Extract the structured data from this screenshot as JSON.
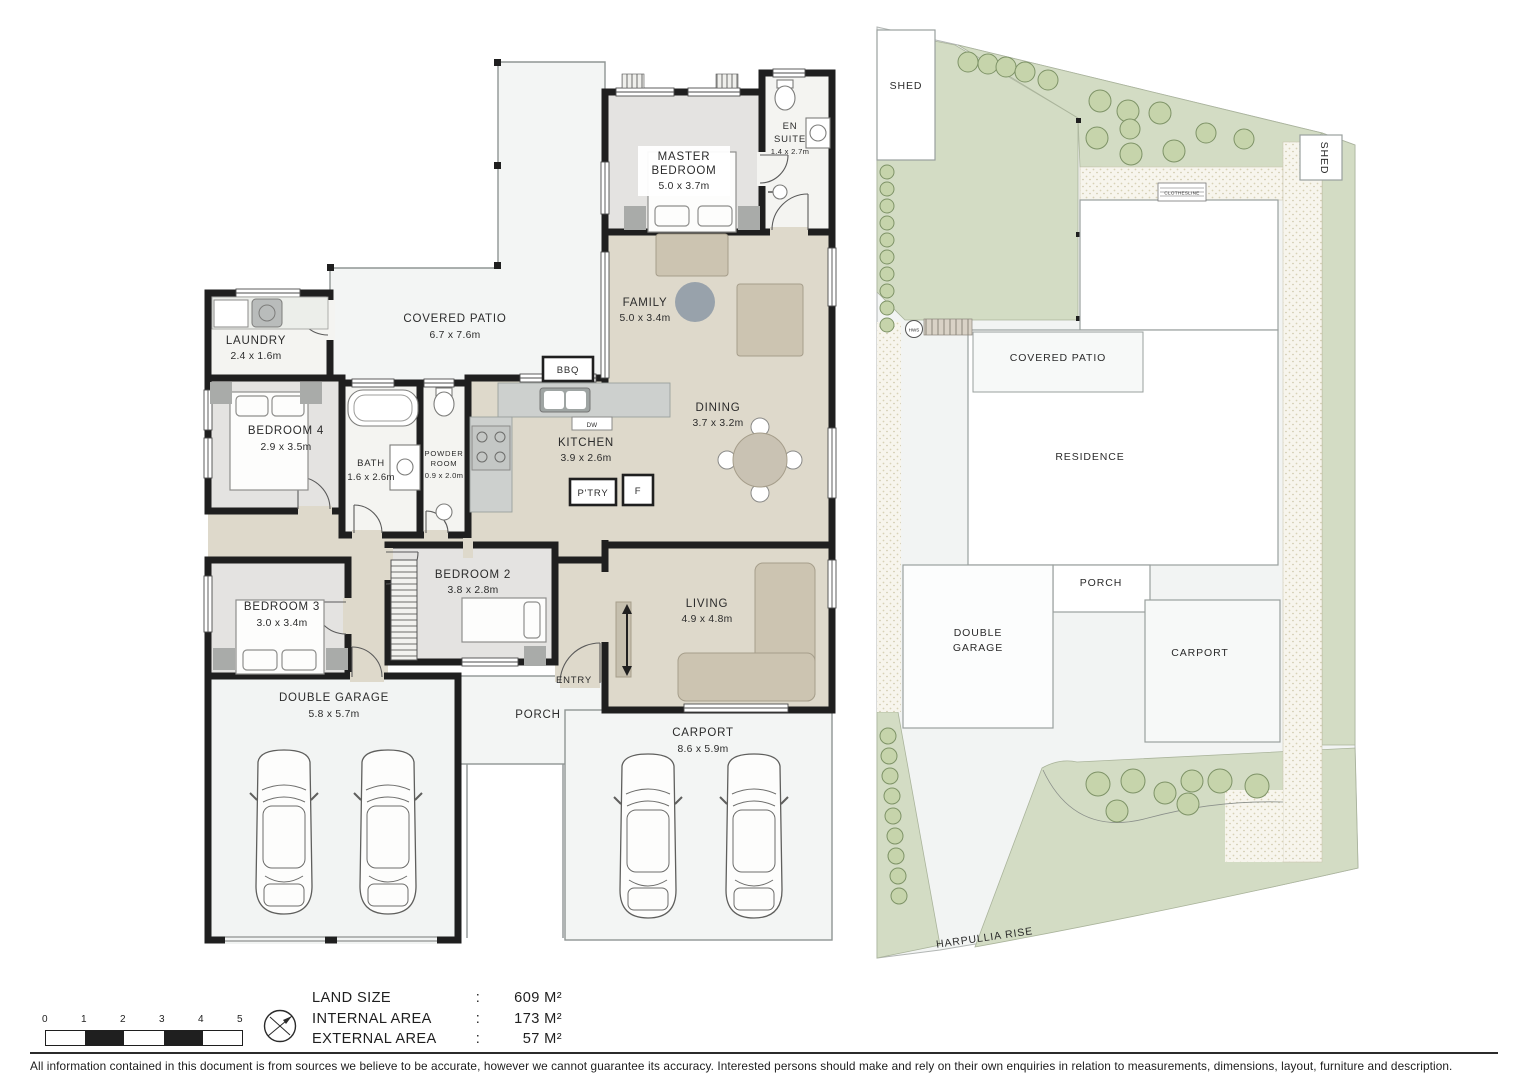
{
  "floorplan": {
    "rooms": {
      "covered_patio": {
        "name": "COVERED PATIO",
        "dims": "6.7 x 7.6m"
      },
      "master": {
        "l1": "MASTER",
        "l2": "BEDROOM",
        "dims": "5.0 x 3.7m"
      },
      "ensuite": {
        "l1": "EN",
        "l2": "SUITE",
        "dims": "1.4 x 2.7m"
      },
      "laundry": {
        "name": "LAUNDRY",
        "dims": "2.4 x 1.6m"
      },
      "family": {
        "name": "FAMILY",
        "dims": "5.0 x 3.4m"
      },
      "bed4": {
        "name": "BEDROOM 4",
        "dims": "2.9 x 3.5m"
      },
      "bath": {
        "name": "BATH",
        "dims": "1.6 x 2.6m"
      },
      "powder": {
        "l1": "POWDER",
        "l2": "ROOM",
        "dims": "0.9 x 2.0m"
      },
      "kitchen": {
        "name": "KITCHEN",
        "dims": "3.9 x 2.6m"
      },
      "dining": {
        "name": "DINING",
        "dims": "3.7 x 3.2m"
      },
      "bed3": {
        "name": "BEDROOM 3",
        "dims": "3.0 x 3.4m"
      },
      "bed2": {
        "name": "BEDROOM 2",
        "dims": "3.8 x 2.8m"
      },
      "living": {
        "name": "LIVING",
        "dims": "4.9 x 4.8m"
      },
      "garage": {
        "name": "DOUBLE GARAGE",
        "dims": "5.8 x 5.7m"
      },
      "porch": {
        "name": "PORCH"
      },
      "entry": {
        "name": "ENTRY"
      },
      "carport": {
        "name": "CARPORT",
        "dims": "8.6 x 5.9m"
      }
    },
    "features": {
      "bbq": "BBQ",
      "pantry": "P'TRY",
      "fridge": "F",
      "dishwasher": "DW"
    }
  },
  "siteplan": {
    "shed_left": "SHED",
    "shed_right": "SHED",
    "covered_patio": "COVERED PATIO",
    "residence": "RESIDENCE",
    "porch": "PORCH",
    "garage_l1": "DOUBLE",
    "garage_l2": "GARAGE",
    "carport": "CARPORT",
    "clothesline": "CLOTHESLINE",
    "hws": "HWS",
    "street": "HARPULLIA RISE"
  },
  "legend": {
    "scale_ticks": [
      "0",
      "1",
      "2",
      "3",
      "4",
      "5"
    ],
    "rows": [
      {
        "label": "LAND SIZE",
        "sep": ":",
        "value": "609 M²"
      },
      {
        "label": "INTERNAL AREA",
        "sep": ":",
        "value": "173 M²"
      },
      {
        "label": "EXTERNAL AREA",
        "sep": ":",
        "value": "57 M²"
      }
    ]
  },
  "disclaimer": "All information contained in this document is from sources we believe to be accurate, however we cannot guarantee its accuracy. Interested persons should make and rely on their own enquiries in relation to measurements, dimensions, layout, furniture and description.",
  "colors": {
    "wall": "#1f1f1f",
    "floor_beige": "#ded9cb",
    "room_grey": "#e4e3e1",
    "grass": "#d3dcc4",
    "text": "#2b2b2b"
  }
}
